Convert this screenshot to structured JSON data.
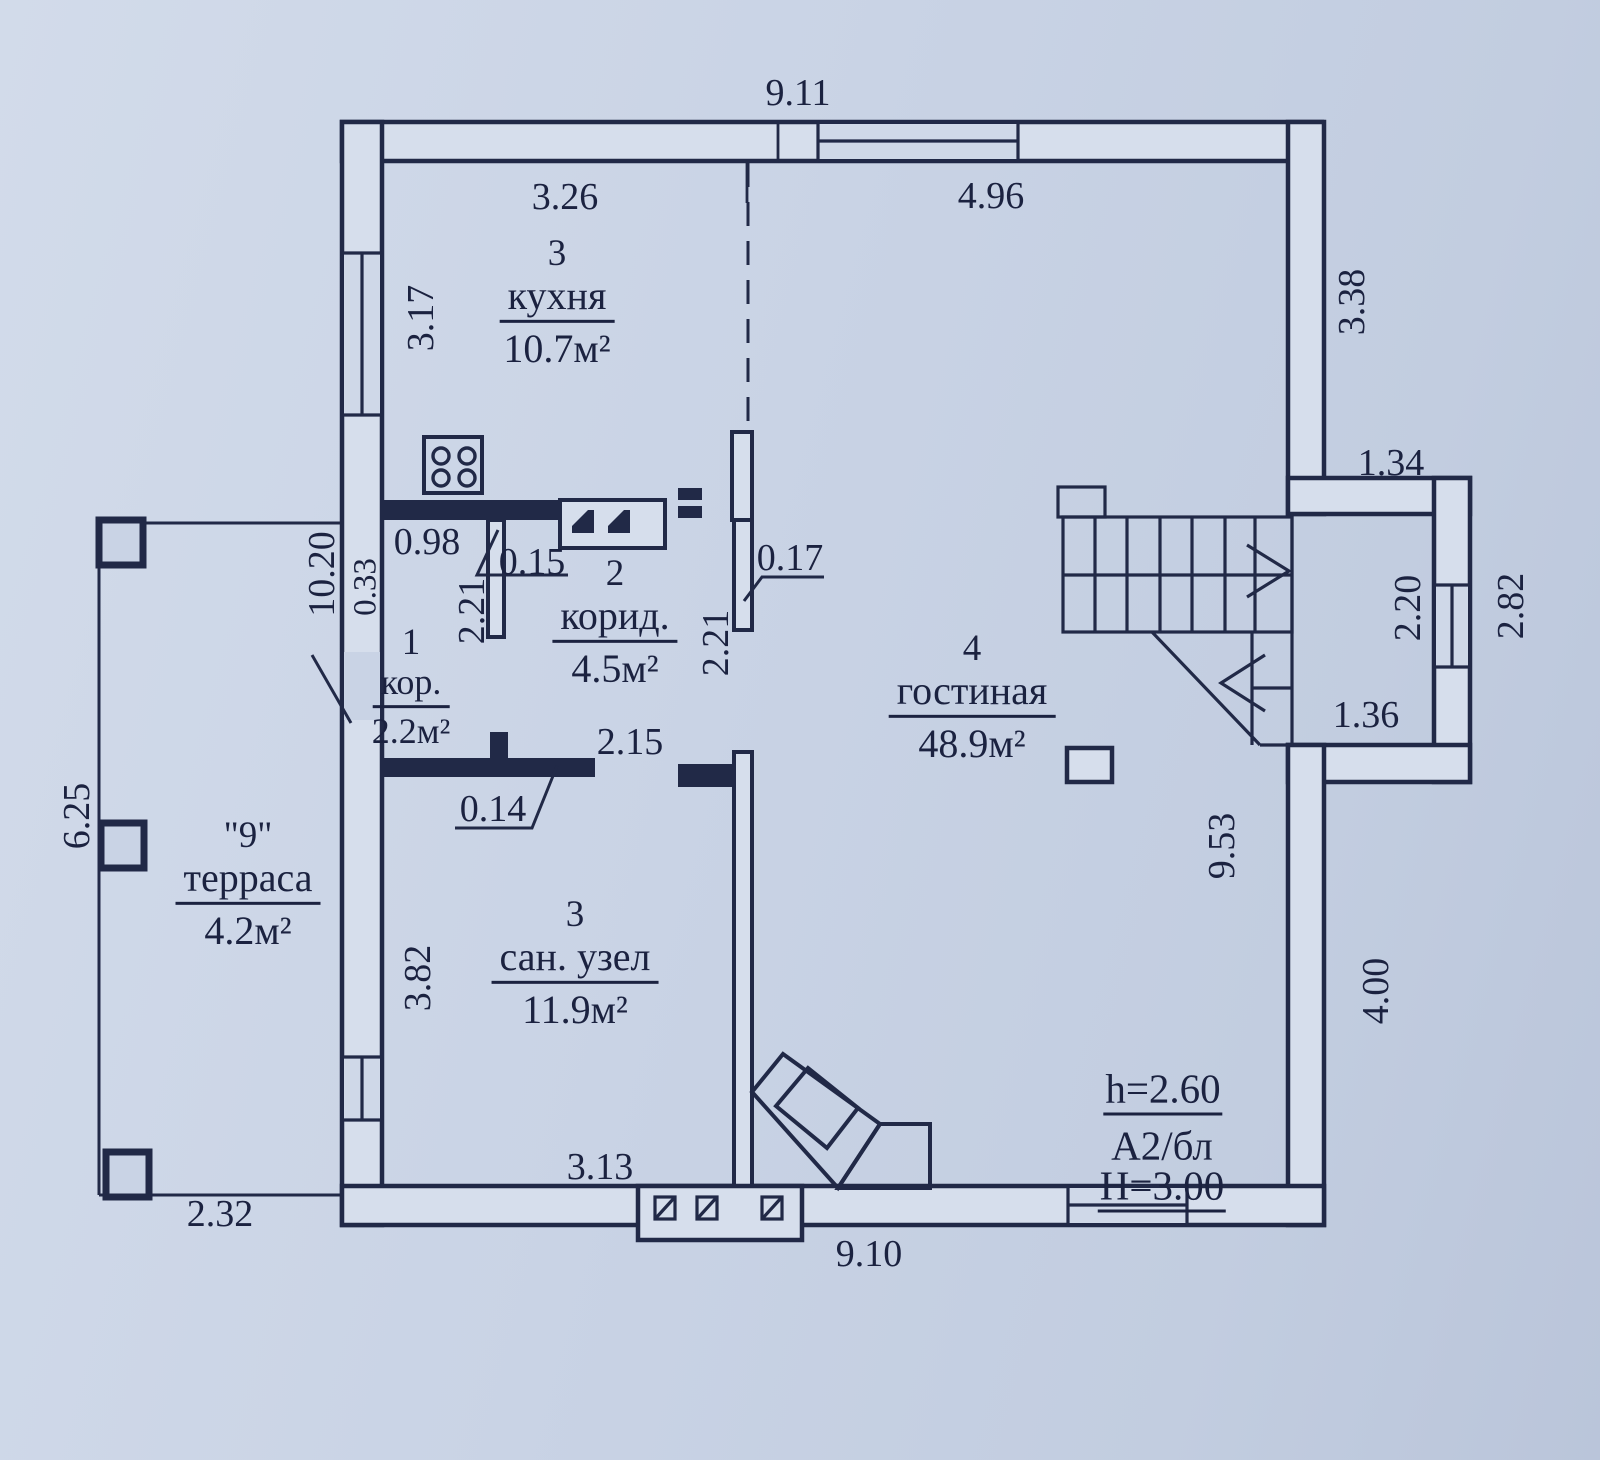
{
  "drawing": {
    "type": "floor-plan",
    "language": "ru",
    "colors": {
      "line": "#212947",
      "paper": "#c9d3e5",
      "wall_fill": "#d6deec",
      "text": "#1b2240"
    }
  },
  "rooms": [
    {
      "num": "3",
      "name": "кухня",
      "area": "10.7м²"
    },
    {
      "num": "2",
      "name": "корид.",
      "area": "4.5м²"
    },
    {
      "num": "1",
      "name": "кор.",
      "area": "2.2м²"
    },
    {
      "num": "4",
      "name": "гостиная",
      "area": "48.9м²"
    },
    {
      "num": "3",
      "name": "сан. узел",
      "area": "11.9м²"
    },
    {
      "num": "\"9\"",
      "name": "терраса",
      "area": "4.2м²"
    }
  ],
  "dims": [
    {
      "id": "overall-top",
      "v": "9.11"
    },
    {
      "id": "kitchen-width",
      "v": "3.26"
    },
    {
      "id": "living-top-width",
      "v": "4.96"
    },
    {
      "id": "right-upper",
      "v": "3.38"
    },
    {
      "id": "step-width",
      "v": "1.34"
    },
    {
      "id": "kitchen-height",
      "v": "3.17"
    },
    {
      "id": "left-wall",
      "v": "10.20"
    },
    {
      "id": "wall-thickness",
      "v": "0.33"
    },
    {
      "id": "kor-width",
      "v": "0.98"
    },
    {
      "id": "partition-1",
      "v": "0.15"
    },
    {
      "id": "corridor-left",
      "v": "2.21"
    },
    {
      "id": "partition-2",
      "v": "0.17"
    },
    {
      "id": "corridor-right",
      "v": "2.21"
    },
    {
      "id": "alcove-height",
      "v": "2.20"
    },
    {
      "id": "alcove-outer",
      "v": "2.82"
    },
    {
      "id": "alcove-width",
      "v": "1.36"
    },
    {
      "id": "living-height",
      "v": "9.53"
    },
    {
      "id": "bath-top",
      "v": "2.15"
    },
    {
      "id": "bath-wall",
      "v": "0.14"
    },
    {
      "id": "terrace-height",
      "v": "6.25"
    },
    {
      "id": "bath-height",
      "v": "3.82"
    },
    {
      "id": "right-lower",
      "v": "4.00"
    },
    {
      "id": "bath-width",
      "v": "3.13"
    },
    {
      "id": "bottom",
      "v": "9.10"
    },
    {
      "id": "terrace-width",
      "v": "2.32"
    }
  ],
  "notes": {
    "ceiling_height": "h=2.60",
    "block_type": "А2/бл",
    "storey_height": "Н=3.00"
  }
}
